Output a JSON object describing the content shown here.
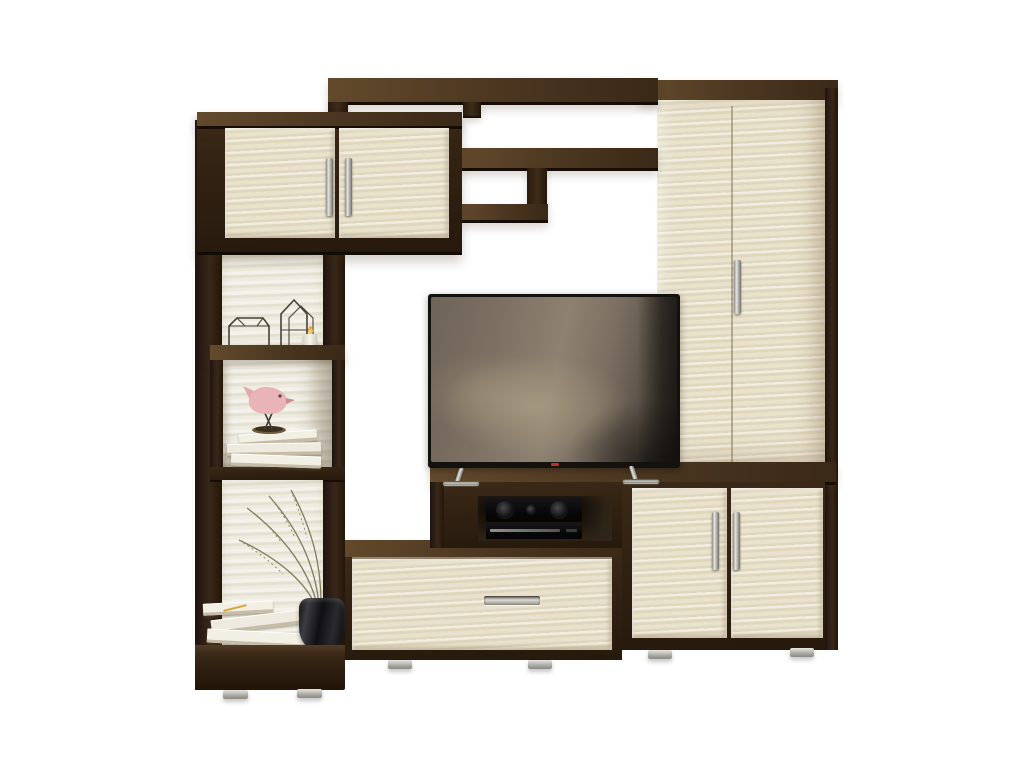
{
  "scene": {
    "type": "furniture product photo",
    "subject": "Living room media wall unit (TV stenka) on white background",
    "style": "two-tone: dark wenge carcass with light shimo-ash fronts",
    "background_color": "#ffffff"
  },
  "palette": {
    "wenge_front": "#332213",
    "wenge_top": "#4e3922",
    "wenge_shadow": "#170e07",
    "ash_front": "#e8e1cc",
    "ash_back_panel": "#edebdf",
    "chrome": "#c9c9c4",
    "tv_bezel": "#14120f",
    "tv_screen_reflection": "#8a7f6d",
    "tv_led_red": "#b5372a",
    "bird_pink": "#e9b3b8",
    "vase_black": "#1a191c",
    "plant_olive": "#7f7d5e",
    "book_white": "#f2efe5",
    "candle_white": "#f7f4ec",
    "flame_orange": "#e8a23d"
  },
  "components": {
    "wall_unit": "Wall unit combining wardrobe, shelving, TV bench and cabinets",
    "upper_cabinet": "Wall cabinet with two ash doors and vertical chrome handles",
    "top_shelf_assembly": "Asymmetric open wenge shelves bridging cabinet and wardrobe",
    "left_column": "Open shelving column with ash back panels on chrome feet",
    "display_box_shelf": "Square wenge display niche with books and bird figurine",
    "wardrobe": "Tall ash-front wardrobe with wenge top, side and chrome handle",
    "tv_stand": "Wenge media box with open niche for AV equipment",
    "drawer_unit": "Low TV bench with one wide ash drawer and chrome pull",
    "right_cabinet": "Two-door ash base cabinet with vertical chrome handles",
    "base_plinth": "Wenge base plinth resting on chrome feet"
  },
  "electronics": {
    "tv": "Flat-screen TV on splayed chrome feet with red standby LED",
    "av_receiver": "Black AV receiver with twin speaker cones and center knob",
    "dvd_player": "Slim black DVD player with brushed metal detailing"
  },
  "decor": {
    "wire_house_left": "Low wireframe house ornament",
    "wire_house_right": "Tall wireframe house ornament",
    "tealight": "White tealight candle with small flame",
    "bird_figurine": "Pink ceramic bird on crossed wire legs and round base",
    "shelf_books": "Stack of three white books under the bird",
    "floor_books": "Angled stack of white books with a yellow pencil",
    "dry_plant": "Dried olive-green grass stems arching left",
    "vase": "Black glossy rounded vase"
  }
}
